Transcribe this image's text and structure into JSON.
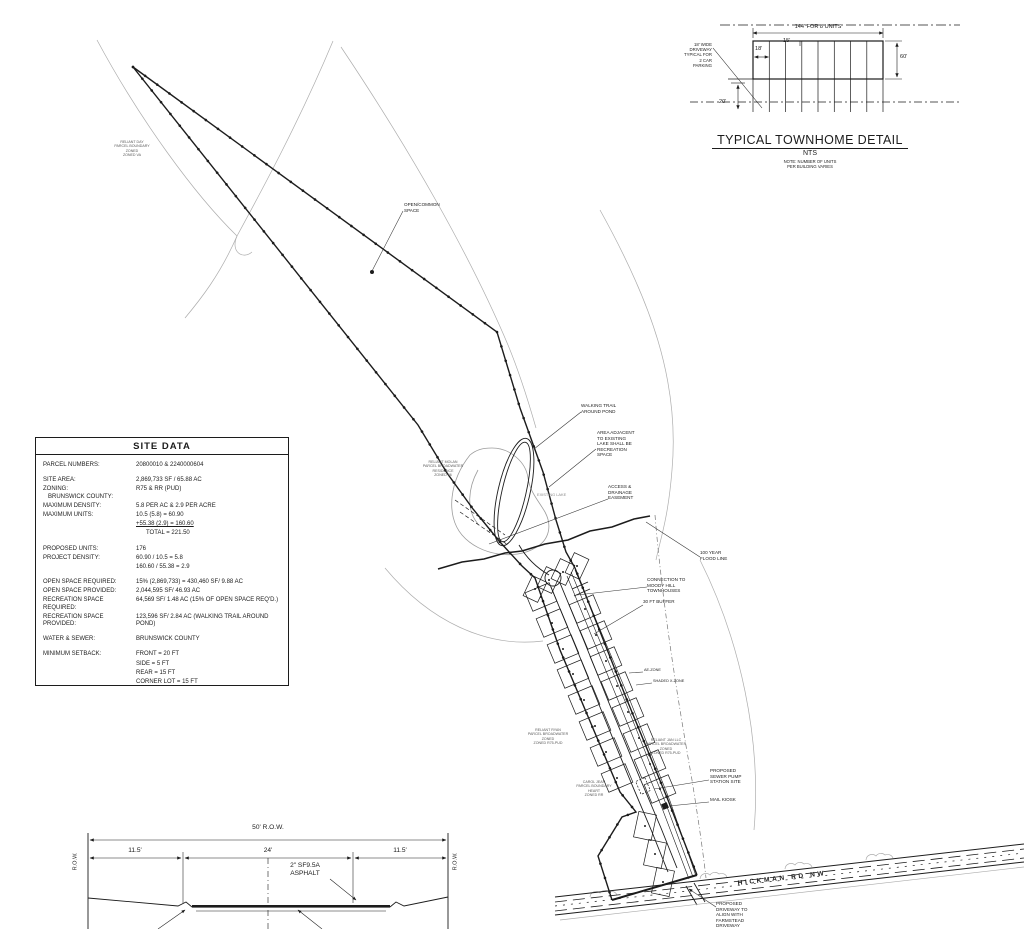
{
  "townhome_detail": {
    "title": "TYPICAL TOWNHOME DETAIL",
    "scale": "NTS",
    "note": "NOTE: NUMBER OF UNITS\nPER BUILDING VARIES",
    "dim_total_width": "144' FOR 8 UNITS",
    "dim_end_unit": "18'",
    "dim_interior_unit": "15'",
    "dim_depth": "60'",
    "dim_driveway_length": "20'",
    "driveway_note": "18' WIDE\nDRIVEWAY\nTYPICAL FOR\n2 CAR\nPARKING"
  },
  "site_data": {
    "title": "SITE DATA",
    "rows": [
      {
        "label": "PARCEL NUMBERS:",
        "value": "20800010 & 2240000604"
      },
      {
        "label": "SITE AREA:",
        "value": "2,869,733 SF / 65.88 AC"
      },
      {
        "label": "ZONING:\n   BRUNSWICK COUNTY:",
        "value": "R75 & RR  (PUD)"
      },
      {
        "label": "MAXIMUM DENSITY:",
        "value": "5.8 PER AC & 2.9 PER ACRE"
      },
      {
        "label": "MAXIMUM UNITS:",
        "value": "10.5 (5.8) = 60.90"
      },
      {
        "label": "",
        "value": "+55.38 (2.9) = 160.60"
      },
      {
        "label": "",
        "value": "      TOTAL = 221.50"
      },
      {
        "label": "PROPOSED UNITS:",
        "value": "176"
      },
      {
        "label": "PROJECT DENSITY:",
        "value": "60.90 / 10.5  = 5.8"
      },
      {
        "label": "",
        "value": "160.60 / 55.38  = 2.9"
      },
      {
        "label": "OPEN SPACE REQUIRED:",
        "value": "15% (2,869,733) = 430,460 SF/ 9.88 AC"
      },
      {
        "label": "OPEN SPACE PROVIDED:",
        "value": "2,044,595 SF/ 46.93 AC"
      },
      {
        "label": "RECREATION SPACE REQUIRED:",
        "value": "64,569 SF/ 1.48 AC (15% OF OPEN SPACE  REQ'D.)"
      },
      {
        "label": "RECREATION SPACE PROVIDED:",
        "value": "123,596 SF/ 2.84 AC (WALKING TRAIL AROUND POND)"
      },
      {
        "label": "WATER & SEWER:",
        "value": "BRUNSWICK COUNTY"
      },
      {
        "label": "MINIMUM SETBACK:",
        "value": "FRONT = 20 FT"
      },
      {
        "label": "",
        "value": "SIDE = 5 FT"
      },
      {
        "label": "",
        "value": "REAR = 15 FT"
      },
      {
        "label": "",
        "value": "CORNER LOT = 15 FT"
      }
    ]
  },
  "cross_section": {
    "dim_row": "50' R.O.W.",
    "dim_left": "11.5'",
    "dim_center": "24'",
    "dim_right": "11.5'",
    "asphalt_note": "2\" SF9.5A\nASPHALT",
    "row_left": "R.O.W.",
    "row_right": "R.O.W."
  },
  "plan": {
    "labels": {
      "open_common_space": "OPEN/COMMON\nSPACE",
      "walking_trail": "WALKING TRAIL\nAROUND POND",
      "recreation_area": "AREA ADJACENT\nTO EXISTING\nLAKE SHALL BE\nRECREATION\nSPACE",
      "existing_lake": "EXISTING LAKE",
      "access_easement": "ACCESS &\nDRAINAGE\nEASEMENT",
      "flood_line": "100 YEAR\nFLOOD LINE",
      "connection": "CONNECTION TO\nMOODY HILL\nTOWNHOUSES",
      "buffer": "30 FT BUFFER",
      "ae_zone": "AE-ZONE",
      "shaded_zone": "SHADED X-ZONE",
      "pump_station": "PROPOSED\nSEWER PUMP\nSTATION SITE",
      "mail_kiosk": "MAIL KIOSK",
      "proposed_driveway": "PROPOSED\nDRIVEWAY TO\nALIGN WITH\nFARMSTEAD\nDRIVEWAY",
      "road_name": "HICKMAN RD NW"
    },
    "adjoiner_notes": [
      {
        "text": "RELIANT DAY\nPARCEL BOUNDARY\nZONED\nZONED VA"
      },
      {
        "text": "RELIANT MOLAN\nPARCEL BROADWATER\nRESIDENCE\nZONED 96"
      },
      {
        "text": "RELIANT RYAN\nPARCEL BROADWATER\nZONED\nZONED R75-PUD"
      },
      {
        "text": "RELIANT JAN LLC\nPARCEL BROADWATER\nZONED\nZONED R75-PUD"
      },
      {
        "text": "CAROL JEAN\nPARCEL BOUNDARY\nHEART\nZONED RR"
      }
    ]
  },
  "colors": {
    "ink": "#1c1c1c",
    "faint_contour": "#adadad",
    "lake": "#9c9c9c"
  }
}
